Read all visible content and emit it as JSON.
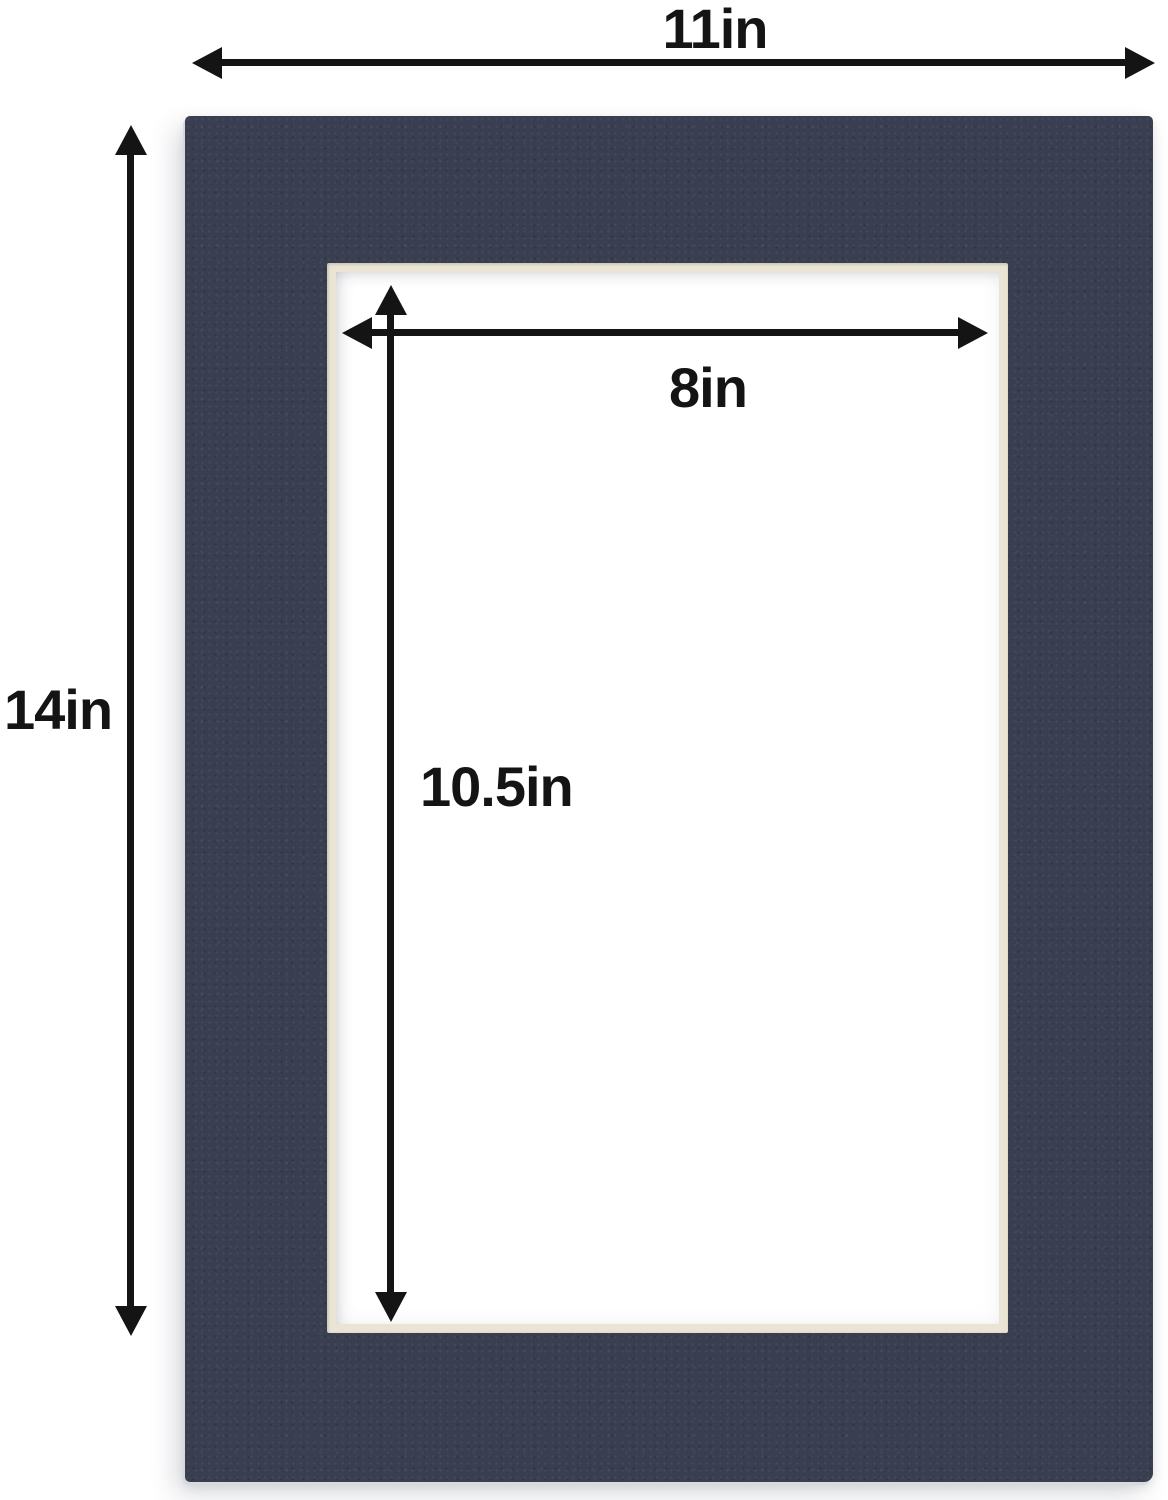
{
  "dimensions": {
    "outer_width": {
      "label": "11in"
    },
    "outer_height": {
      "label": "14in"
    },
    "opening_width": {
      "label": "8in"
    },
    "opening_height": {
      "label": "10.5in"
    }
  },
  "icons": {
    "outer_width_arrow": "double-headed-horizontal-arrow",
    "outer_height_arrow": "double-headed-vertical-arrow",
    "opening_width_arrow": "double-headed-horizontal-arrow",
    "opening_height_arrow": "double-headed-vertical-arrow"
  },
  "colors": {
    "mat_navy": "#3a3e51",
    "bevel_cream": "#e9e4d3",
    "backing_white": "#ffffff",
    "annotation_black": "#141414",
    "background_white": "#ffffff"
  }
}
